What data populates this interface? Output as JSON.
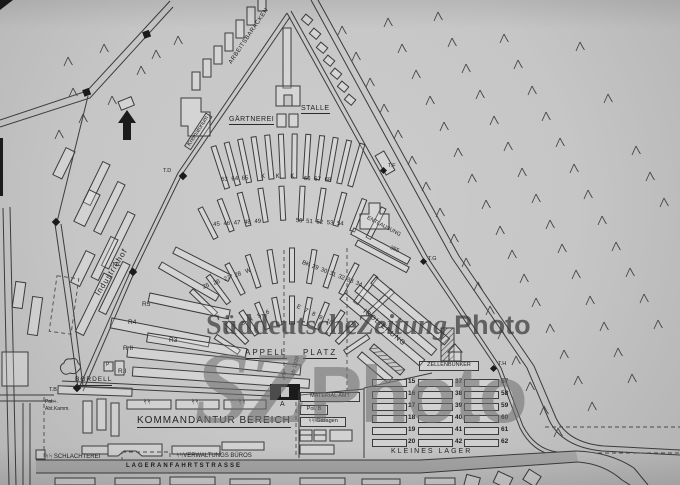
{
  "watermark": {
    "part1": "Süddeutsche",
    "part2": "Zeitung",
    "part3": "Photo",
    "big1": "SZ",
    "big2": "Photo"
  },
  "labels": {
    "arbeitsbaracken": "ARBEITSBARACKEN",
    "krematorium": "Krematorium",
    "gaertnerei": "GÄRTNEREI",
    "staelle": "STALLE",
    "industriehof": "Industriehof",
    "entlausung": "ENTLAUSUNG",
    "entlausung_number": "355",
    "isolierung": "ISOLIERUNG",
    "zellenbunker": "ZELLENBUNKER",
    "appell": "APPELL",
    "platz": "PLATZ",
    "ab_1938": "ab 1938",
    "gate_f": "F",
    "gate_a": "A",
    "bordell": "BORDELL",
    "p_building": "P",
    "pol_abt_line1": "Pol.+.",
    "pol_abt_line2": "Abt.Kamm.",
    "kommandantur_bereich": "KOMMANDANTUR BEREICH",
    "ss_runes": "ᛋᛋ",
    "schlachterei": "ᛋᛋ SCHLACHTEREI",
    "verwaltungs_bueros": "ᛋᛋVERWALTUNGS BÜROS",
    "lageranfahrtstrasse": "LAGERANFAHRTSTRASSE",
    "material_amt": "MATERIAL AMT",
    "pol_b": "Pol. B",
    "ss_garagen": "ᛋᛋ Garagen",
    "kleines_lager": "KLEINES LAGER"
  },
  "r_blocks": [
    "R5",
    "R4",
    "R3",
    "R II",
    "R.I"
  ],
  "towers": [
    "T.D",
    "T.C",
    "T.B",
    "T.F",
    "T.G",
    "T.H"
  ],
  "barrack_numbers": {
    "row1_left": "63 64 65",
    "row1_mid": "K K K",
    "row1_right": "66 67 68",
    "row2_left": "45 46 47 48 49",
    "row2_right": "50 51 52 53 54",
    "row3_left": "25 26 27 28 W",
    "row3_right": "BK 29 30 31 32 33 34",
    "row4_left": "1 2 3 4 5 6",
    "row4_right": "E 7 8 9 10"
  },
  "kleines_lager_rows": [
    [
      "15",
      "37",
      "57"
    ],
    [
      "16",
      "38",
      "58"
    ],
    [
      "17",
      "39",
      "59"
    ],
    [
      "18",
      "40",
      "60"
    ],
    [
      "19",
      "41",
      "61"
    ],
    [
      "20",
      "42",
      "62"
    ]
  ]
}
